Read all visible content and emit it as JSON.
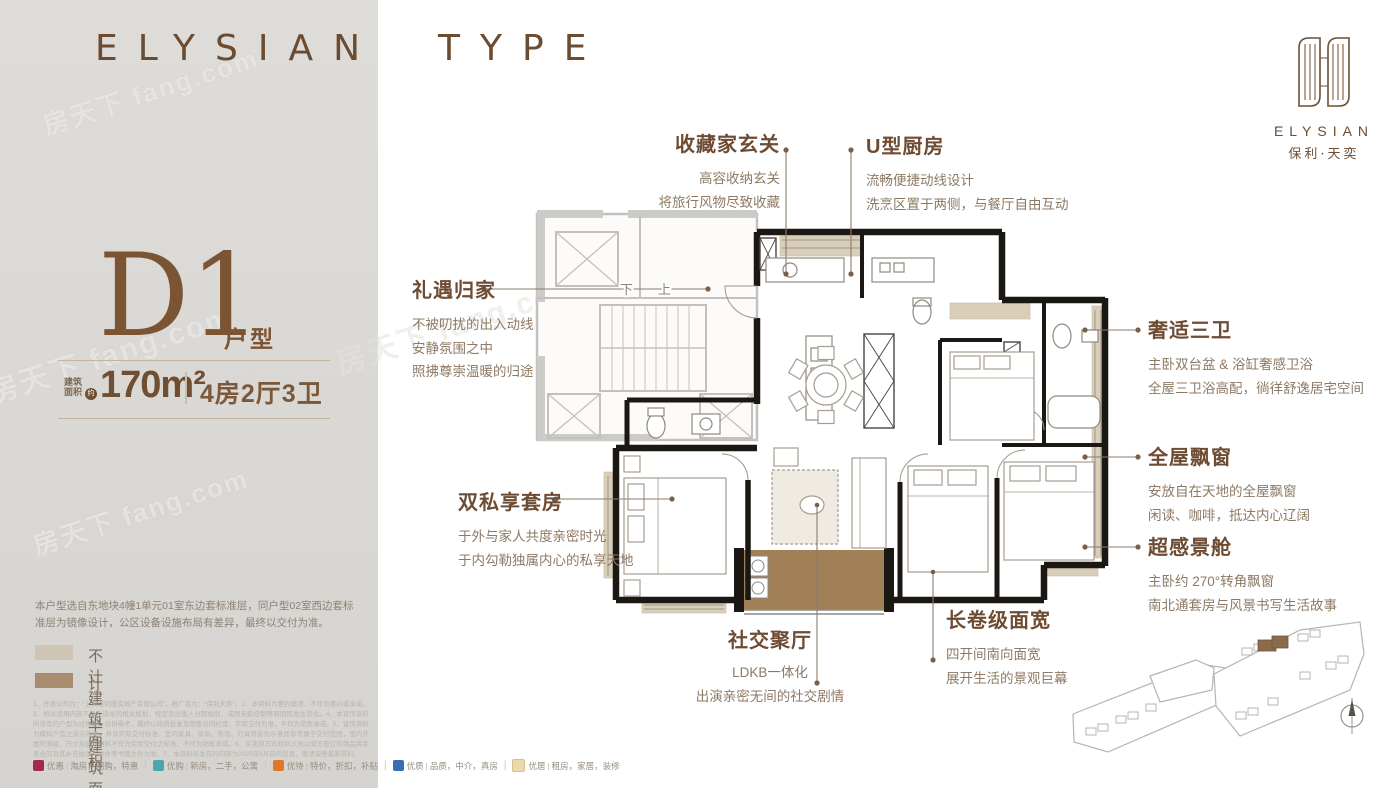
{
  "page": {
    "title_word1": "ELYSIAN",
    "title_word2": "TYPE"
  },
  "brand": {
    "name": "ELYSIAN",
    "cn": "保利·天奕"
  },
  "unit": {
    "code": "D1",
    "code_label": "户型",
    "area_prefix_1": "建筑",
    "area_prefix_2": "面积",
    "area_approx": "约",
    "area": "170m²",
    "rooms": "4房2厅3卫"
  },
  "callouts": {
    "foyer": {
      "title": "收藏家玄关",
      "line1": "高容收纳玄关",
      "line2": "将旅行风物尽致收藏"
    },
    "kitchen": {
      "title": "U型厨房",
      "line1": "流畅便捷动线设计",
      "line2": "洗烹区置于两侧，与餐厅自由互动"
    },
    "entry": {
      "title": "礼遇归家",
      "line1": "不被叨扰的出入动线",
      "line2": "安静氛围之中",
      "line3": "照拂尊崇温暖的归途"
    },
    "suite": {
      "title": "双私享套房",
      "line1": "于外与家人共度亲密时光",
      "line2": "于内勾勒独属内心的私享天地"
    },
    "baths": {
      "title": "奢适三卫",
      "line1": "主卧双台盆 & 浴缸奢感卫浴",
      "line2": "全屋三卫浴高配，徜徉舒逸居宅空间"
    },
    "bay": {
      "title": "全屋飘窗",
      "line1": "安放自在天地的全屋飘窗",
      "line2": "闲读、咖啡，抵达内心辽阔"
    },
    "cabin": {
      "title": "超感景舱",
      "line1": "主卧约 270°转角飘窗",
      "line2": "南北通套房与风景书写生活故事"
    },
    "width": {
      "title": "长卷级面宽",
      "line1": "四开间南向面宽",
      "line2": "展开生活的景观巨幕"
    },
    "living": {
      "title": "社交聚厅",
      "line1": "LDKB一体化",
      "line2": "出演亲密无间的社交剧情"
    }
  },
  "plan": {
    "stair_down": "下",
    "stair_up": "上"
  },
  "note": "本户型选自东地块4幢1单元01室东边套标准层，同户型02室西边套标准层为镜像设计，公区设备设施布局有差异，最终以交付为准。",
  "legend": {
    "item1": {
      "label": "不计建筑面积",
      "color": "#cfc5b5"
    },
    "item2": {
      "label": "计一半建筑面积",
      "color": "#a78c6d"
    }
  },
  "fine_print": "1、开发公司为：“上海保利晟房地产有限公司”，推广名为：“保利天奕”。2、本资料为要约邀请，不作为要约或承诺。3、相关适用内容不涉及选址的相关规划、规定及出售人分期规划，或因未能控制等原因而发生变化。4、本宣传资料所涉及的户型为过程稿，仅供参考，最终以政府批复及销售合同约定、实际交付为准，不作为销售承诺。5、宣传资料为模拟户型之演示效果，并非实际交付标准，室内家具、家私、陈设、灯具等皆为示意而非专属于交付范围，室内外面积测绘、尺寸及建筑材料不作为实际交付之标准，不作为销售承诺。6、买卖双方的权利义务以双方签订的商品房买卖合同及其补充协议、附件等书面文件为准。7、本资料所发布的内容为2025年8月前的信息，敬请留意最新资料。",
  "watermark": "房天下 fang.com",
  "footer": {
    "b1": {
      "label": "优惠",
      "desc": "淘房，团购，特惠",
      "color": "#a3294e"
    },
    "b2": {
      "label": "优购",
      "desc": "新房，二手，公寓",
      "color": "#49a8ad"
    },
    "b3": {
      "label": "优待",
      "desc": "特价，折扣，补贴",
      "color": "#e0782b"
    },
    "b4": {
      "label": "优质",
      "desc": "品质，中介，真房",
      "color": "#3a6cb5"
    },
    "b5": {
      "label": "优居",
      "desc": "租房，家居，装修",
      "color": "#ecd9ab"
    }
  },
  "colors": {
    "accent": "#6b4e33",
    "body_text": "#8d7965",
    "panel_bg": "#dbd9d6",
    "bay_fill": "#d9ceb8",
    "balcony_fill": "#a28057",
    "wall": "#1b1713"
  }
}
